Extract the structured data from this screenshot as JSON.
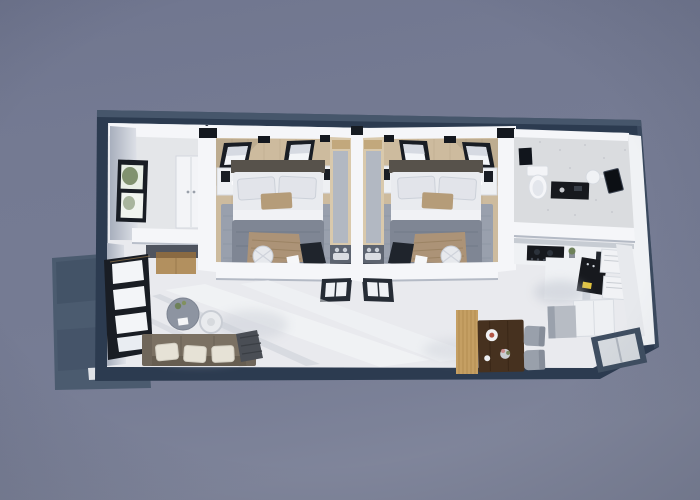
{
  "scene": {
    "type": "3d-architectural-render",
    "view": "top-down dollhouse floor plan, slight perspective tilt",
    "subject": "rectangular small home: two mirrored bedroom suites, bathroom, kitchen, shared living-dining room, side balcony slab"
  },
  "colors": {
    "background": "#757b93",
    "exterior_frame": "#2c3b50",
    "frame_highlight": "#55657a",
    "balcony": "#4b5b6f",
    "wall": "#f5f6f9",
    "wall_shade": "#c2c8d2",
    "floor": "#e9eaee",
    "floor_bright": "#f6f7f9",
    "floor_shadow": "#c7cbd4",
    "wood_floor": "#cdbb9e",
    "rug": "#99a0ad",
    "bed_sheet": "#e9ebef",
    "bed_duvet": "#7f8694",
    "bed_throw": "#ac9377",
    "headboard": "#57524b",
    "pillow_tan": "#b59c79",
    "bathroom_floor": "#dadcdf",
    "cabinet": "#eff1f4",
    "counter_dark": "#17191e",
    "accent_yellow": "#e3c43c",
    "fridge": "#b7bcc4",
    "sofa": "#7b7163",
    "sofa_pillow": "#e6e2d6",
    "coffee_table": "#8d94a1",
    "side_table": "#e9ebee",
    "dining_table": "#46311f",
    "partition_wood": "#c59f63",
    "chair": "#99a0ab",
    "window_frame": "#191d24",
    "glass": "#f3f5f8",
    "greenery": "#6e8159",
    "desk_wood": "#b2905f",
    "dark_item": "#1f242c",
    "vanity_counter": "#5d6470"
  },
  "rooms": [
    {
      "id": "entry-closet",
      "label": "Entry closet room",
      "furniture": [
        "white wardrobe",
        "side window with greenery",
        "wood cabinet nook"
      ]
    },
    {
      "id": "bedroom-1",
      "label": "Bedroom suite 1",
      "furniture": [
        "double bed",
        "two nightstands with black lamps",
        "gray area rug",
        "round pouf",
        "vanity strip with sink counter",
        "two tilted wall windows",
        "open glass door"
      ]
    },
    {
      "id": "bedroom-2",
      "label": "Bedroom suite 2 (mirror of suite 1)",
      "furniture": [
        "double bed",
        "two nightstands with black lamps",
        "gray area rug",
        "round pouf",
        "vanity strip with sink counter",
        "two tilted wall windows",
        "open glass door"
      ]
    },
    {
      "id": "bathroom",
      "label": "Bathroom",
      "furniture": [
        "toilet",
        "dark vanity counter",
        "round wall light",
        "black wall panel"
      ]
    },
    {
      "id": "kitchen",
      "label": "Kitchen",
      "furniture": [
        "white cabinet run",
        "black cooktop",
        "black counter with yellow label",
        "white appliance boxes",
        "gray fridge",
        "corner glass panel"
      ]
    },
    {
      "id": "living-room",
      "label": "Living room",
      "furniture": [
        "brown sofa with three white pillows",
        "dark throw basket",
        "round gray coffee table with plant",
        "white ring side table",
        "tall black-framed window"
      ]
    },
    {
      "id": "dining-area",
      "label": "Dining area",
      "furniture": [
        "dark wood dining table",
        "two gray chairs",
        "wood slat partition",
        "plates and flowers"
      ]
    },
    {
      "id": "balcony",
      "label": "Side balcony slab",
      "furniture": []
    }
  ]
}
